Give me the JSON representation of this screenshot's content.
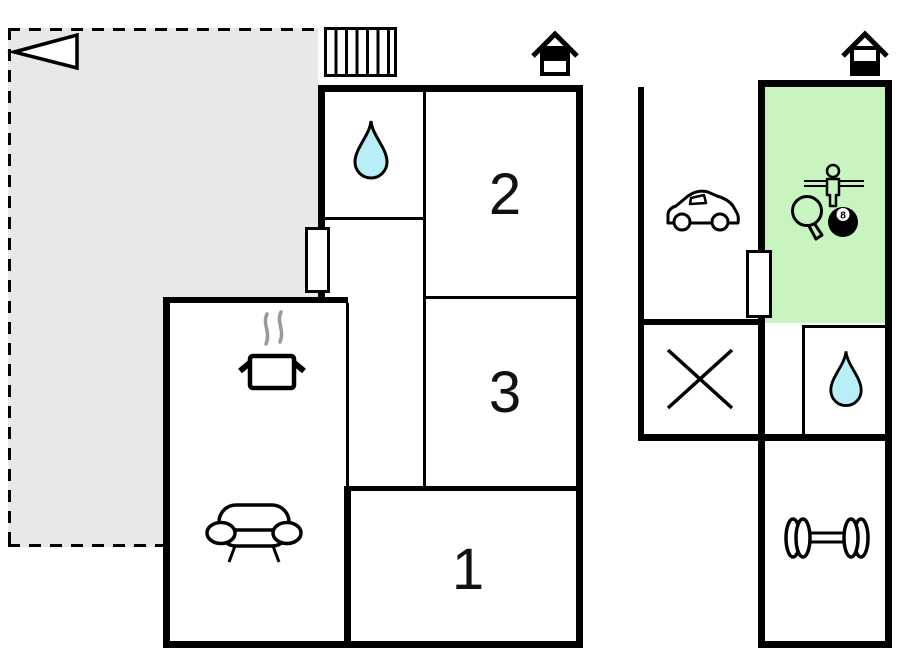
{
  "title": "holiday-home-floor-plan",
  "colors": {
    "terrace_fill": "#e8e8e8",
    "highlight_room_fill": "#c8f4bf",
    "water_drop_fill": "#b8eef5",
    "wall": "#000000",
    "background": "#ffffff",
    "steam_gray": "#999999"
  },
  "rooms": {
    "room1": "1",
    "room2": "2",
    "room3": "3"
  },
  "labels": {
    "eight_ball": "8"
  },
  "left_building": {
    "areas": [
      {
        "name": "terrace",
        "icon": "entrance-arrow"
      },
      {
        "name": "bathroom",
        "icon": "water-drop"
      },
      {
        "name": "bedroom-2",
        "label": "2"
      },
      {
        "name": "bedroom-3",
        "label": "3"
      },
      {
        "name": "bedroom-1",
        "label": "1"
      },
      {
        "name": "kitchen-living-room",
        "icons": [
          "cooking-pot",
          "sofa"
        ]
      },
      {
        "name": "hallway"
      }
    ],
    "exterior_icons": [
      "stairs",
      "chimney"
    ]
  },
  "right_building": {
    "areas": [
      {
        "name": "carport",
        "icon": "car"
      },
      {
        "name": "game-room",
        "icons": [
          "foosball-player",
          "table-tennis-paddle",
          "billiard-eight-ball"
        ],
        "highlighted": true
      },
      {
        "name": "storage",
        "icon": "cross"
      },
      {
        "name": "bathroom-2",
        "icon": "water-drop"
      },
      {
        "name": "gym",
        "icon": "dumbbell"
      }
    ],
    "exterior_icons": [
      "chimney"
    ]
  }
}
